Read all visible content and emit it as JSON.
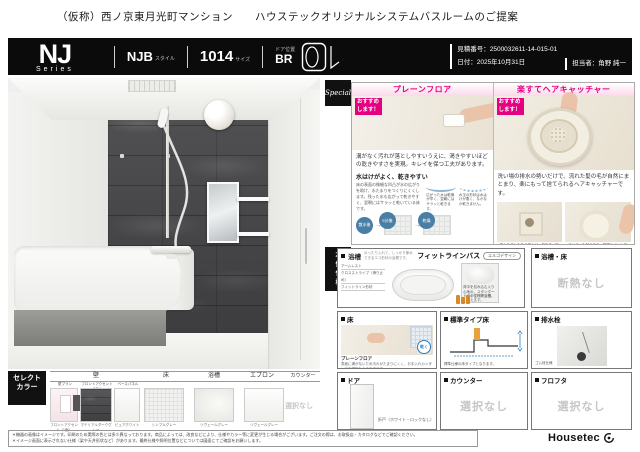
{
  "colors": {
    "accent_pink": "#e4007f",
    "badge_black": "#111111",
    "accent_wall": "#47474a"
  },
  "page": {
    "title": "（仮称）西ノ京東月光町マンション　　ハウステックオリジナルシステムバスルームのご提案"
  },
  "header": {
    "series": "NJ",
    "series_sub": "Series",
    "style_value": "NJB",
    "style_label": "スタイル",
    "size_value": "1014",
    "size_label": "サイズ",
    "door_pos_label": "ドア位置",
    "door_pos_value": "BR",
    "quote_label": "見積番号：",
    "quote_value": "2500032611-14-015-01",
    "date_label": "日付：",
    "date_value": "2025年10月31日",
    "person_label": "担当者：",
    "person_value": "角野 純一"
  },
  "special": {
    "badge": "Special",
    "panels": [
      {
        "title": "プレーンフロア",
        "ribbon": "おすすめ します！",
        "body": "溝がなく汚れが落としやすいうえに、渇きやすいほどの乾きやすさを実現。キレイを保つ工夫があります。",
        "sub_title": "水はけがよく、乾きやすい",
        "sub_body": "床の表面の微細な凹凸が水の広がりを助け、水たまりをつくりにくくします。残った水も広がって乾きやすく、翌朝にはサラッと乾いている床です。",
        "note1": "広がった水は乾燥が早く、翌朝にはサラッと乾きます。",
        "note2": "水玉の形状は水はけが悪く、なかなか乾きません。",
        "steps": [
          "散水後",
          "5分後",
          "乾燥"
        ]
      },
      {
        "title": "楽すてヘアキャッチャー",
        "ribbon": "おすすめ します！",
        "body": "洗い場の排水の勢いだけで、流れた髪の毛が自然にまとまり、楽にもって捨てられるヘアキャッチャーです。",
        "caption1": "排水を流した後の排水が、渦をまく形状です。",
        "caption2": "まとまった髪の毛も、簡単にポイ！捨てられます。"
      }
    ]
  },
  "spec": {
    "badge": "本体仕様",
    "bath": {
      "label": "浴槽",
      "note": "ゆったり入れて、しっかり節水できるエコ形状の浴槽です。",
      "title": "フィットラインバス",
      "shape_badge": "エルゴデザイン",
      "ann1": "アームレスト",
      "ann2": "クロスストライプ（滑り止め）",
      "ann3": "フィットライン形状",
      "right_caption": "背中を包み込む入り心地の、スタンダードタイプFRP浴槽。",
      "bottle_note": "中性洗剤で洗えます。"
    },
    "bath_floor": {
      "label": "浴槽・床",
      "value": "断熱なし"
    },
    "floor": {
      "label": "床",
      "name": "プレーンフロア",
      "desc": "表面に溝がないため汚れがたまりにくく、お手入れカンタンでお掃除もラクな床です。",
      "stamp": "乾く"
    },
    "floor_type": {
      "label": "標準タイプ床",
      "caption": "標準仕様の床タイプとなります。"
    },
    "drain": {
      "label": "排水栓",
      "caption": "ゴム栓仕様"
    },
    "door": {
      "label": "ドア",
      "caption": "折戸（ホワイト・ロックなし）"
    },
    "counter": {
      "label": "カウンター",
      "value": "選択なし"
    },
    "lid": {
      "label": "フロフタ",
      "value": "選択なし"
    }
  },
  "select": {
    "badge_line1": "セレクト",
    "badge_line2": "カラー",
    "headers": [
      "壁",
      "床",
      "浴槽",
      "エプロン",
      "カウンター"
    ],
    "wall_plan_label": "壁プラン",
    "wall_plan_caption": "フロントアクセント（1面）",
    "accent_label": "フロントアクセントパネル",
    "accent_caption": "マテリアルダークグレー",
    "base_label": "ベースパネル",
    "base_caption": "ピュアホワイト",
    "floor_caption": "シンプルグレー",
    "bath_caption": "リヴェールグレー",
    "apron_caption": "リヴェールグレー",
    "counter_value": "選択なし"
  },
  "footer": {
    "note1": "＊機器の画像はイメージです。印刷のため実際の色とは多少異なっております。商品によっては、改良などにより、仕様やカラー等に変更が生じる場合がございます。ご注文の際は、お取扱店・カタログなどでご確認ください。",
    "note2": "＊イメージ画面に表示されない仕様（梁や天井形状など）があります。最終仕様や照明位置などについては図面にてご確認をお願いします。",
    "logo": "Housetec"
  }
}
